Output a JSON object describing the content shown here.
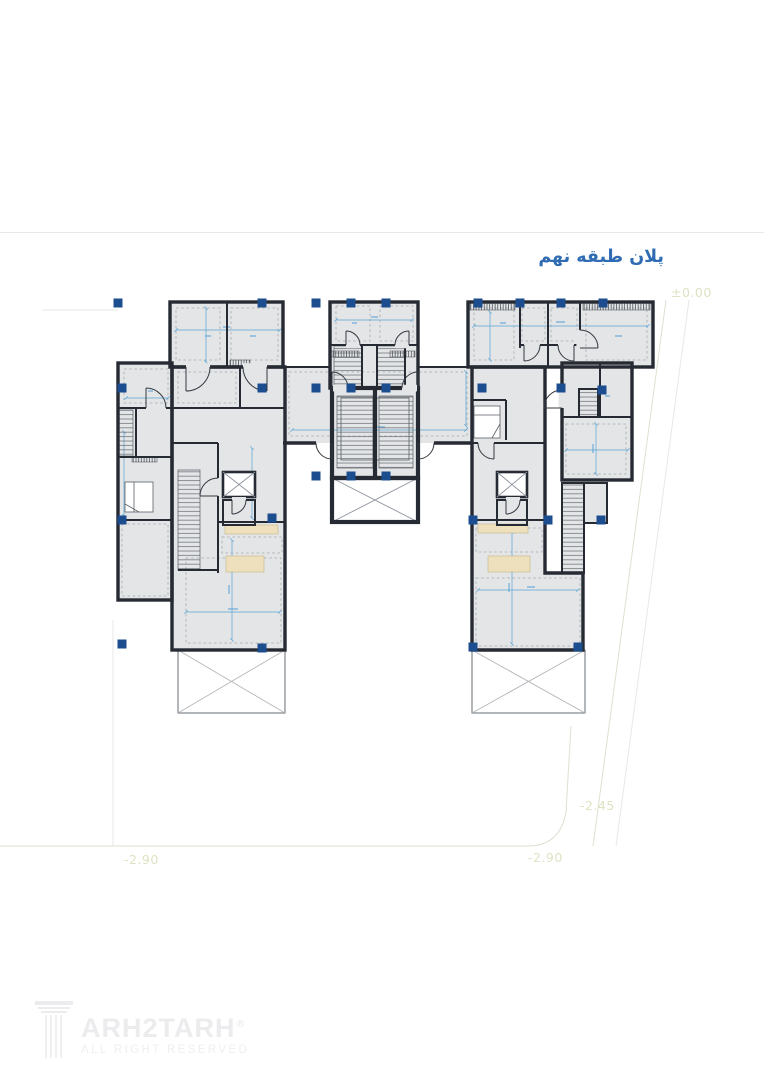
{
  "sheet": {
    "title": "پلان طبقه نهم",
    "elevations": {
      "datum": "±0.00",
      "level_a": "-2.45",
      "level_b_left": "-2.90",
      "level_b_right": "-2.90"
    }
  },
  "logo": {
    "brand": "ARH2TARH",
    "registered": "®",
    "tagline": "ALL RIGHT RESERVED"
  },
  "colors": {
    "wall": "#262a33",
    "floor": "#e3e5e6",
    "column": "#1c4d8f",
    "dimension": "#5aa5d6",
    "counter": "#eee0bd",
    "title": "#2f6cb3",
    "elevation_text": "#dfe2c4"
  }
}
